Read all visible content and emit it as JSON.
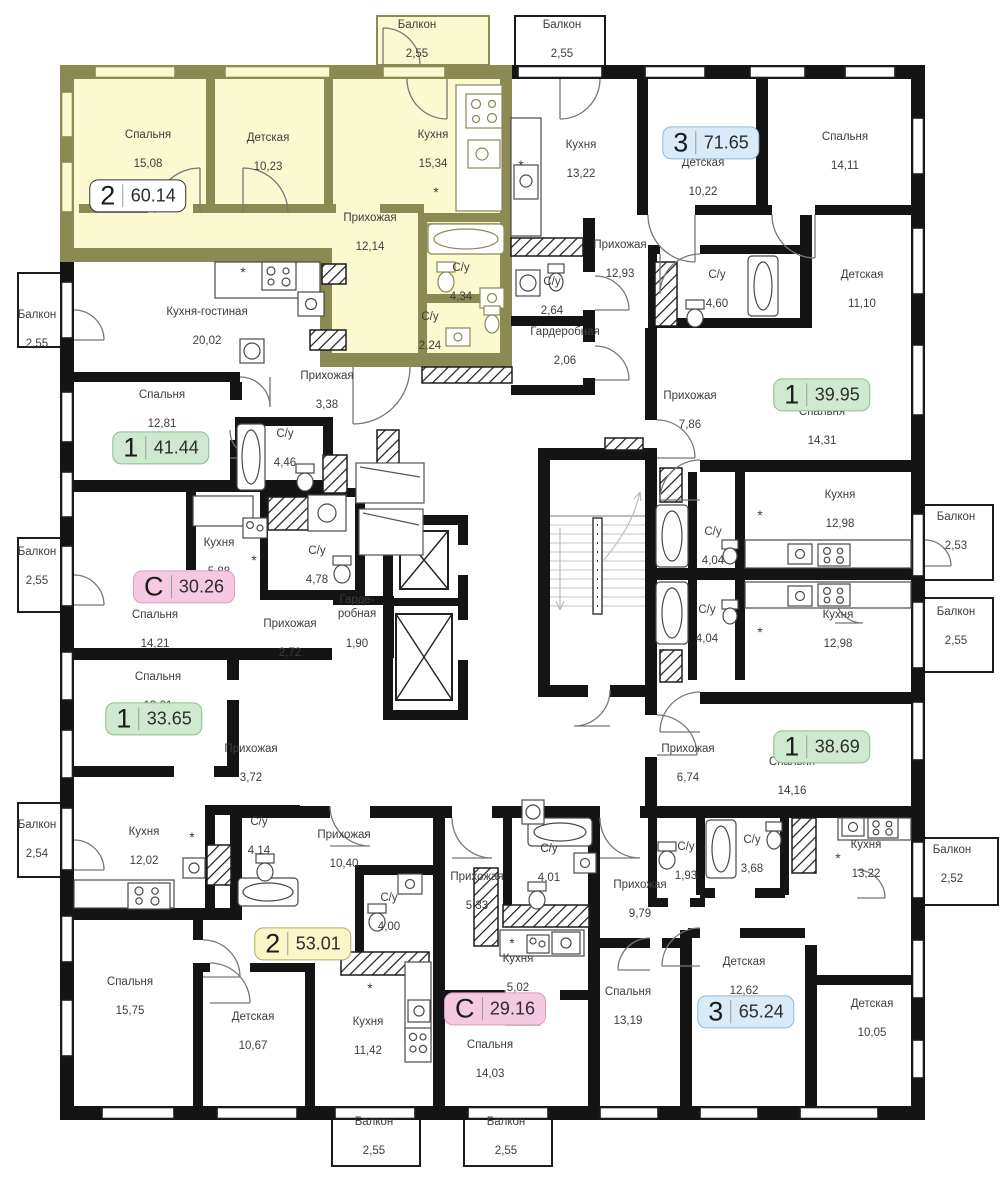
{
  "plan": {
    "title": "floor-plan",
    "star_symbol": "*",
    "colors": {
      "wall": "#141414",
      "accent_wall": "#8a8a52",
      "highlight_fill": "#fbf9cf",
      "label_text": "#3d3d3d"
    }
  },
  "badge_styles": {
    "green": {
      "bg": "#cfe9d0",
      "border": "#8abd8d"
    },
    "blue": {
      "bg": "#d9eaf8",
      "border": "#8fb7d6"
    },
    "pink": {
      "bg": "#f5c9e1",
      "border": "#db9bc0"
    },
    "yellow": {
      "bg": "#faf6c7",
      "border": "#b0ac6e"
    },
    "white": {
      "bg": "#ffffff",
      "border": "#333333"
    }
  },
  "badges": [
    {
      "type": "2",
      "area": "60.14",
      "x": 138,
      "y": 196,
      "style": "white"
    },
    {
      "type": "3",
      "area": "71.65",
      "x": 711,
      "y": 143,
      "style": "blue"
    },
    {
      "type": "1",
      "area": "41.44",
      "x": 161,
      "y": 448,
      "style": "green"
    },
    {
      "type": "С",
      "area": "30.26",
      "x": 184,
      "y": 587,
      "style": "pink"
    },
    {
      "type": "1",
      "area": "33.65",
      "x": 154,
      "y": 719,
      "style": "green"
    },
    {
      "type": "1",
      "area": "39.95",
      "x": 822,
      "y": 395,
      "style": "green"
    },
    {
      "type": "1",
      "area": "38.69",
      "x": 822,
      "y": 747,
      "style": "green"
    },
    {
      "type": "2",
      "area": "53.01",
      "x": 303,
      "y": 944,
      "style": "yellow"
    },
    {
      "type": "С",
      "area": "29.16",
      "x": 495,
      "y": 1009,
      "style": "pink"
    },
    {
      "type": "3",
      "area": "65.24",
      "x": 746,
      "y": 1012,
      "style": "blue"
    }
  ],
  "rooms": [
    {
      "name": "Балкон",
      "area": "2,55",
      "x": 417,
      "y": 40
    },
    {
      "name": "Спальня",
      "area": "15,08",
      "x": 148,
      "y": 150
    },
    {
      "name": "Детская",
      "area": "10,23",
      "x": 268,
      "y": 153
    },
    {
      "name": "Кухня",
      "area": "15,34",
      "x": 433,
      "y": 150
    },
    {
      "name": "Прихожая",
      "area": "12,14",
      "x": 370,
      "y": 233
    },
    {
      "name": "С/у",
      "area": "4,34",
      "x": 461,
      "y": 283
    },
    {
      "name": "С/у",
      "area": "2,24",
      "x": 430,
      "y": 332
    },
    {
      "name": "Балкон",
      "area": "2,55",
      "x": 562,
      "y": 40
    },
    {
      "name": "Кухня",
      "area": "13,22",
      "x": 581,
      "y": 160
    },
    {
      "name": "Детская",
      "area": "10,22",
      "x": 703,
      "y": 178
    },
    {
      "name": "Спальня",
      "area": "14,11",
      "x": 845,
      "y": 152
    },
    {
      "name": "Прихожая",
      "area": "12,93",
      "x": 620,
      "y": 260
    },
    {
      "name": "С/у",
      "area": "2,64",
      "x": 552,
      "y": 297
    },
    {
      "name": "Гардеробная",
      "area": "2,06",
      "x": 565,
      "y": 347
    },
    {
      "name": "С/у",
      "area": "4,60",
      "x": 717,
      "y": 290
    },
    {
      "name": "Детская",
      "area": "11,10",
      "x": 862,
      "y": 290
    },
    {
      "name": "Балкон",
      "area": "2,55",
      "x": 37,
      "y": 330
    },
    {
      "name": "Кухня-гостиная",
      "area": "20,02",
      "x": 207,
      "y": 327
    },
    {
      "name": "Спальня",
      "area": "12,81",
      "x": 162,
      "y": 410
    },
    {
      "name": "Прихожая",
      "area": "3,38",
      "x": 327,
      "y": 391
    },
    {
      "name": "С/у",
      "area": "4,46",
      "x": 285,
      "y": 449
    },
    {
      "name": "Прихожая",
      "area": "7,86",
      "x": 690,
      "y": 411
    },
    {
      "name": "Спальня",
      "area": "14,31",
      "x": 822,
      "y": 427
    },
    {
      "name": "Кухня",
      "area": "12,98",
      "x": 840,
      "y": 510
    },
    {
      "name": "Балкон",
      "area": "2,53",
      "x": 956,
      "y": 532
    },
    {
      "name": "С/у",
      "area": "4,04",
      "x": 713,
      "y": 547
    },
    {
      "name": "С/у",
      "area": "4,04",
      "x": 707,
      "y": 625
    },
    {
      "name": "Кухня",
      "area": "12,98",
      "x": 838,
      "y": 630
    },
    {
      "name": "Балкон",
      "area": "2,55",
      "x": 956,
      "y": 627
    },
    {
      "name": "Балкон",
      "area": "2,55",
      "x": 37,
      "y": 567
    },
    {
      "name": "Кухня",
      "area": "5,88",
      "x": 219,
      "y": 558
    },
    {
      "name": "С/у",
      "area": "4,78",
      "x": 317,
      "y": 566
    },
    {
      "name": "Спальня",
      "area": "14,21",
      "x": 155,
      "y": 630
    },
    {
      "name": "Прихожая",
      "area": "2,72",
      "x": 290,
      "y": 639
    },
    {
      "name": "Гарде-\nробная",
      "area": "1,90",
      "x": 357,
      "y": 622
    },
    {
      "name": "Спальня",
      "area": "13,01",
      "x": 158,
      "y": 692
    },
    {
      "name": "Прихожая",
      "area": "3,72",
      "x": 251,
      "y": 764
    },
    {
      "name": "Прихожая",
      "area": "6,74",
      "x": 688,
      "y": 764
    },
    {
      "name": "Спальня",
      "area": "14,16",
      "x": 792,
      "y": 777
    },
    {
      "name": "Балкон",
      "area": "2,54",
      "x": 37,
      "y": 840
    },
    {
      "name": "Кухня",
      "area": "12,02",
      "x": 144,
      "y": 847
    },
    {
      "name": "С/у",
      "area": "4,14",
      "x": 259,
      "y": 837
    },
    {
      "name": "Прихожая",
      "area": "10,40",
      "x": 344,
      "y": 850
    },
    {
      "name": "С/у",
      "area": "4,00",
      "x": 389,
      "y": 913
    },
    {
      "name": "Прихожая",
      "area": "5,33",
      "x": 477,
      "y": 892
    },
    {
      "name": "С/у",
      "area": "4,01",
      "x": 549,
      "y": 864
    },
    {
      "name": "Прихожая",
      "area": "9,79",
      "x": 640,
      "y": 900
    },
    {
      "name": "С/у",
      "area": "1,93",
      "x": 686,
      "y": 862
    },
    {
      "name": "С/у",
      "area": "3,68",
      "x": 752,
      "y": 855
    },
    {
      "name": "Кухня",
      "area": "13,22",
      "x": 866,
      "y": 860
    },
    {
      "name": "Балкон",
      "area": "2,52",
      "x": 952,
      "y": 865
    },
    {
      "name": "Кухня",
      "area": "5,02",
      "x": 518,
      "y": 974
    },
    {
      "name": "Спальня",
      "area": "13,19",
      "x": 628,
      "y": 1007
    },
    {
      "name": "Детская",
      "area": "12,62",
      "x": 744,
      "y": 977
    },
    {
      "name": "Спальня",
      "area": "15,75",
      "x": 130,
      "y": 997
    },
    {
      "name": "Детская",
      "area": "10,67",
      "x": 253,
      "y": 1032
    },
    {
      "name": "Кухня",
      "area": "11,42",
      "x": 368,
      "y": 1037
    },
    {
      "name": "Спальня",
      "area": "14,03",
      "x": 490,
      "y": 1060
    },
    {
      "name": "Детская",
      "area": "10,05",
      "x": 872,
      "y": 1019
    },
    {
      "name": "Балкон",
      "area": "2,55",
      "x": 374,
      "y": 1137
    },
    {
      "name": "Балкон",
      "area": "2,55",
      "x": 506,
      "y": 1137
    }
  ],
  "stars": [
    {
      "x": 436,
      "y": 192
    },
    {
      "x": 243,
      "y": 272
    },
    {
      "x": 521,
      "y": 165
    },
    {
      "x": 370,
      "y": 988
    },
    {
      "x": 512,
      "y": 943
    },
    {
      "x": 760,
      "y": 515
    },
    {
      "x": 760,
      "y": 632
    },
    {
      "x": 838,
      "y": 858
    },
    {
      "x": 254,
      "y": 560
    },
    {
      "x": 192,
      "y": 837
    }
  ]
}
